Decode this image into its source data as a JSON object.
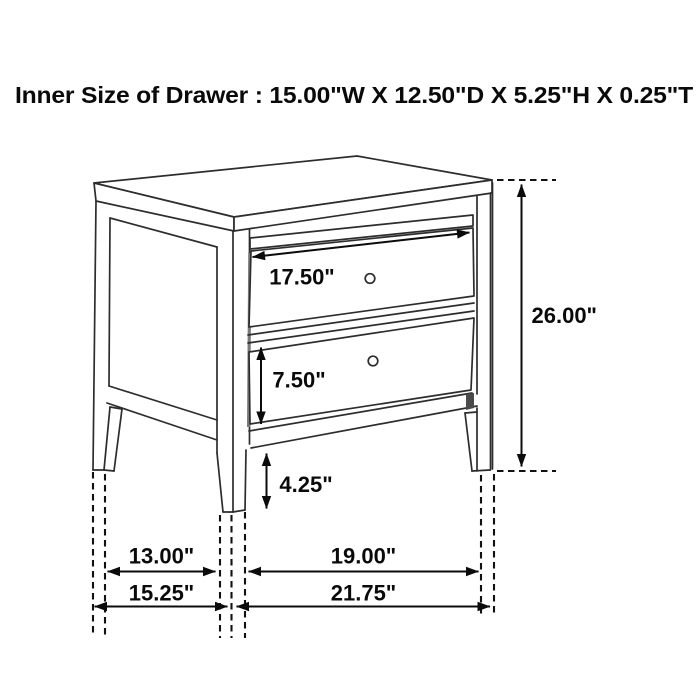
{
  "title": "Inner Size of Drawer : 15.00\"W X 12.50\"D X 5.25\"H X 0.25\"T",
  "figure": {
    "item": "two-drawer nightstand technical line drawing",
    "drawer_count": 2,
    "colors": {
      "background": "#ffffff",
      "line": "#2d2d2d",
      "dimension": "#0b0b0b"
    }
  },
  "inner_drawer_size": {
    "width": "15.00\"",
    "depth": "12.50\"",
    "height": "5.25\"",
    "thickness": "0.25\""
  },
  "dimensions": {
    "drawer_width": {
      "label": "17.50\""
    },
    "overall_height": {
      "label": "26.00\""
    },
    "drawer_face_height": {
      "label": "7.50\""
    },
    "leg_height": {
      "label": "4.25\""
    },
    "side_inner_span": {
      "label": "13.00\""
    },
    "front_inner_span": {
      "label": "19.00\""
    },
    "side_outer_depth": {
      "label": "15.25\""
    },
    "front_outer_width": {
      "label": "21.75\""
    }
  }
}
